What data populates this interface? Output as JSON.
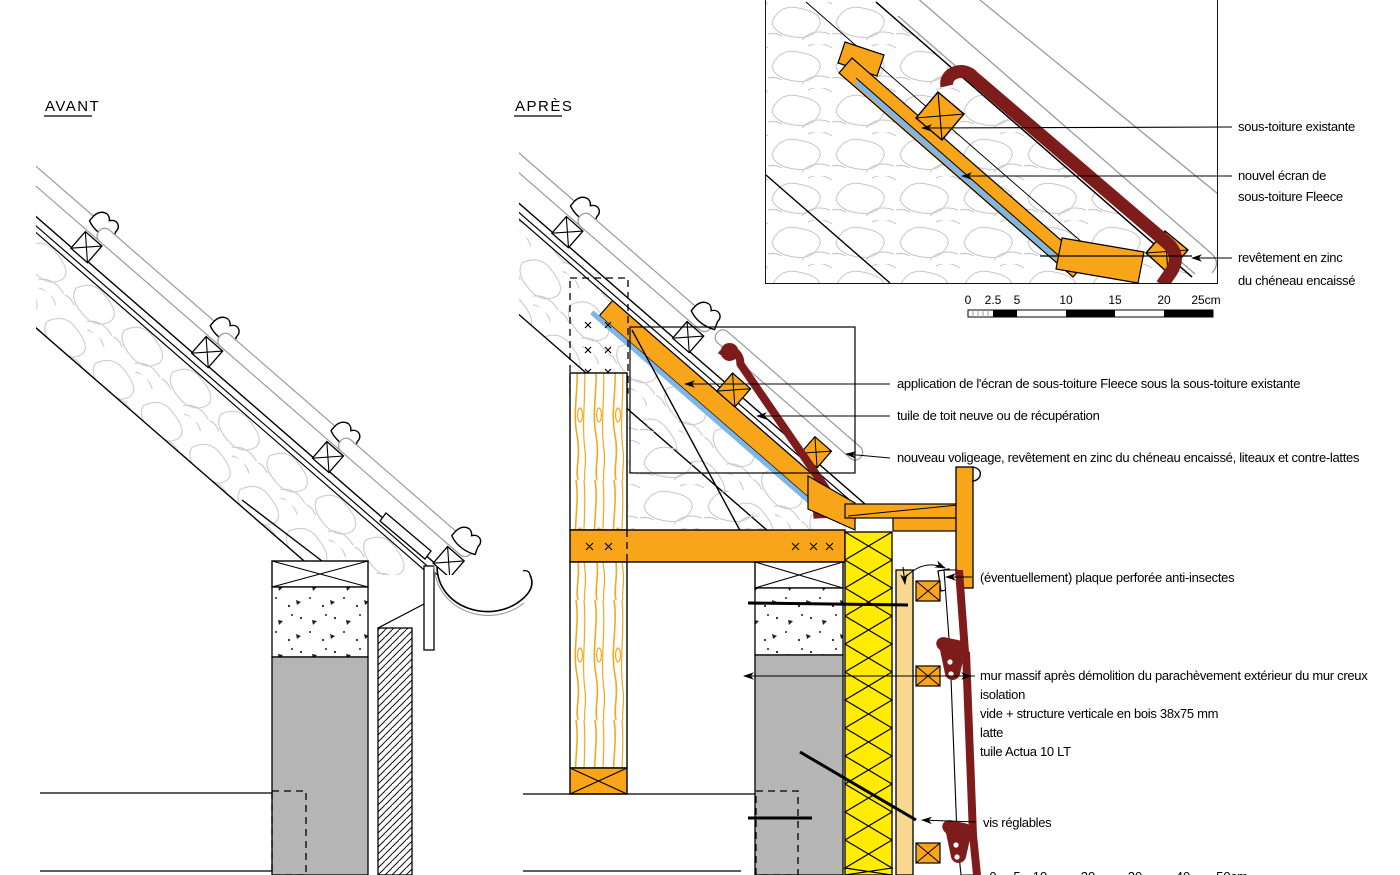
{
  "titles": {
    "before": "AVANT",
    "after": "APRÈS"
  },
  "inset_labels": {
    "existing_subroof": "sous-toiture existante",
    "fleece_line1": "nouvel écran de",
    "fleece_line2": "sous-toiture Fleece",
    "zinc_line1": "revêtement en zinc",
    "zinc_line2": "du chéneau encaissé"
  },
  "main_labels": {
    "application": "application de l'écran de sous-toiture Fleece sous la sous-toiture existante",
    "tuile": "tuile de toit neuve ou de récupération",
    "voligeage": "nouveau voligeage, revêtement en zinc du chéneau encaissé, liteaux et contre-lattes",
    "plaque": "(éventuellement) plaque perforée anti-insectes",
    "mur": "mur massif après démolition du parachèvement extérieur du mur creux",
    "isolation": "isolation",
    "vide": "vide + structure verticale en bois 38x75 mm",
    "latte": "latte",
    "tuile_actua": "tuile Actua 10 LT",
    "vis": "vis réglables"
  },
  "scalebar_detail": {
    "unit": "cm",
    "ticks": [
      "0",
      "2.5",
      "5",
      "10",
      "15",
      "20",
      "25cm"
    ]
  },
  "scalebar_main": {
    "unit": "cm",
    "ticks": [
      "0",
      "5",
      "10",
      "20",
      "30",
      "40",
      "50cm"
    ]
  },
  "colors": {
    "wood_orange": "#F9A51A",
    "insulation_yellow": "#FFEC00",
    "latte_tan": "#F8D98F",
    "tile_maroon": "#7E1B1B",
    "fleece_blue": "#7EB6E8",
    "wall_gray": "#B5B5B5"
  }
}
